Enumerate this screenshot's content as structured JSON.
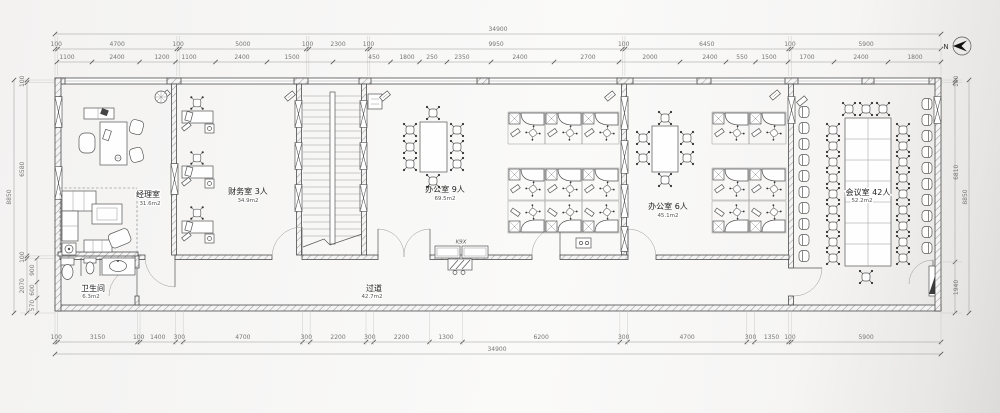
{
  "compass": {
    "label": "N"
  },
  "rooms": {
    "manager": {
      "name": "经理室",
      "area": "31.6m2"
    },
    "finance": {
      "name": "财务室 3人",
      "area": "34.9m2"
    },
    "office9": {
      "name": "办公室 9人",
      "area": "69.5m2"
    },
    "office6": {
      "name": "办公室 6人",
      "area": "45.1m2"
    },
    "meeting": {
      "name": "会议室 42人",
      "area": "52.2m2"
    },
    "bathroom": {
      "name": "卫生间",
      "area": "6.3m2"
    },
    "corridor": {
      "name": "过道",
      "area": "42.7m2"
    }
  },
  "annotations": {
    "copier": "K9X"
  },
  "dimensions": {
    "top_total": "34900",
    "top_row2": [
      "100",
      "4700",
      "100",
      "5000",
      "100",
      "2300",
      "100",
      "9950",
      "100",
      "6450",
      "100",
      "5900"
    ],
    "top_row3": [
      "1100",
      "2400",
      "1200",
      "1100",
      "2400",
      "1500",
      "450",
      "1800",
      "250",
      "2350",
      "2400",
      "2700",
      "2000",
      "2400",
      "550",
      "1500",
      "1700",
      "2400",
      "1800"
    ],
    "bottom_row": [
      "100",
      "3150",
      "100",
      "1400",
      "300",
      "4700",
      "300",
      "2200",
      "300",
      "2200",
      "1300",
      "6200",
      "300",
      "4700",
      "300",
      "1350",
      "100",
      "5900"
    ],
    "bottom_total": "34900",
    "left_total": "8850",
    "left_chain": [
      "100",
      "6580",
      "100",
      "2070"
    ],
    "left_sub": [
      "900",
      "600",
      "570"
    ],
    "right_total": "8850",
    "right_chain": [
      "100",
      "6810",
      "1940"
    ]
  }
}
